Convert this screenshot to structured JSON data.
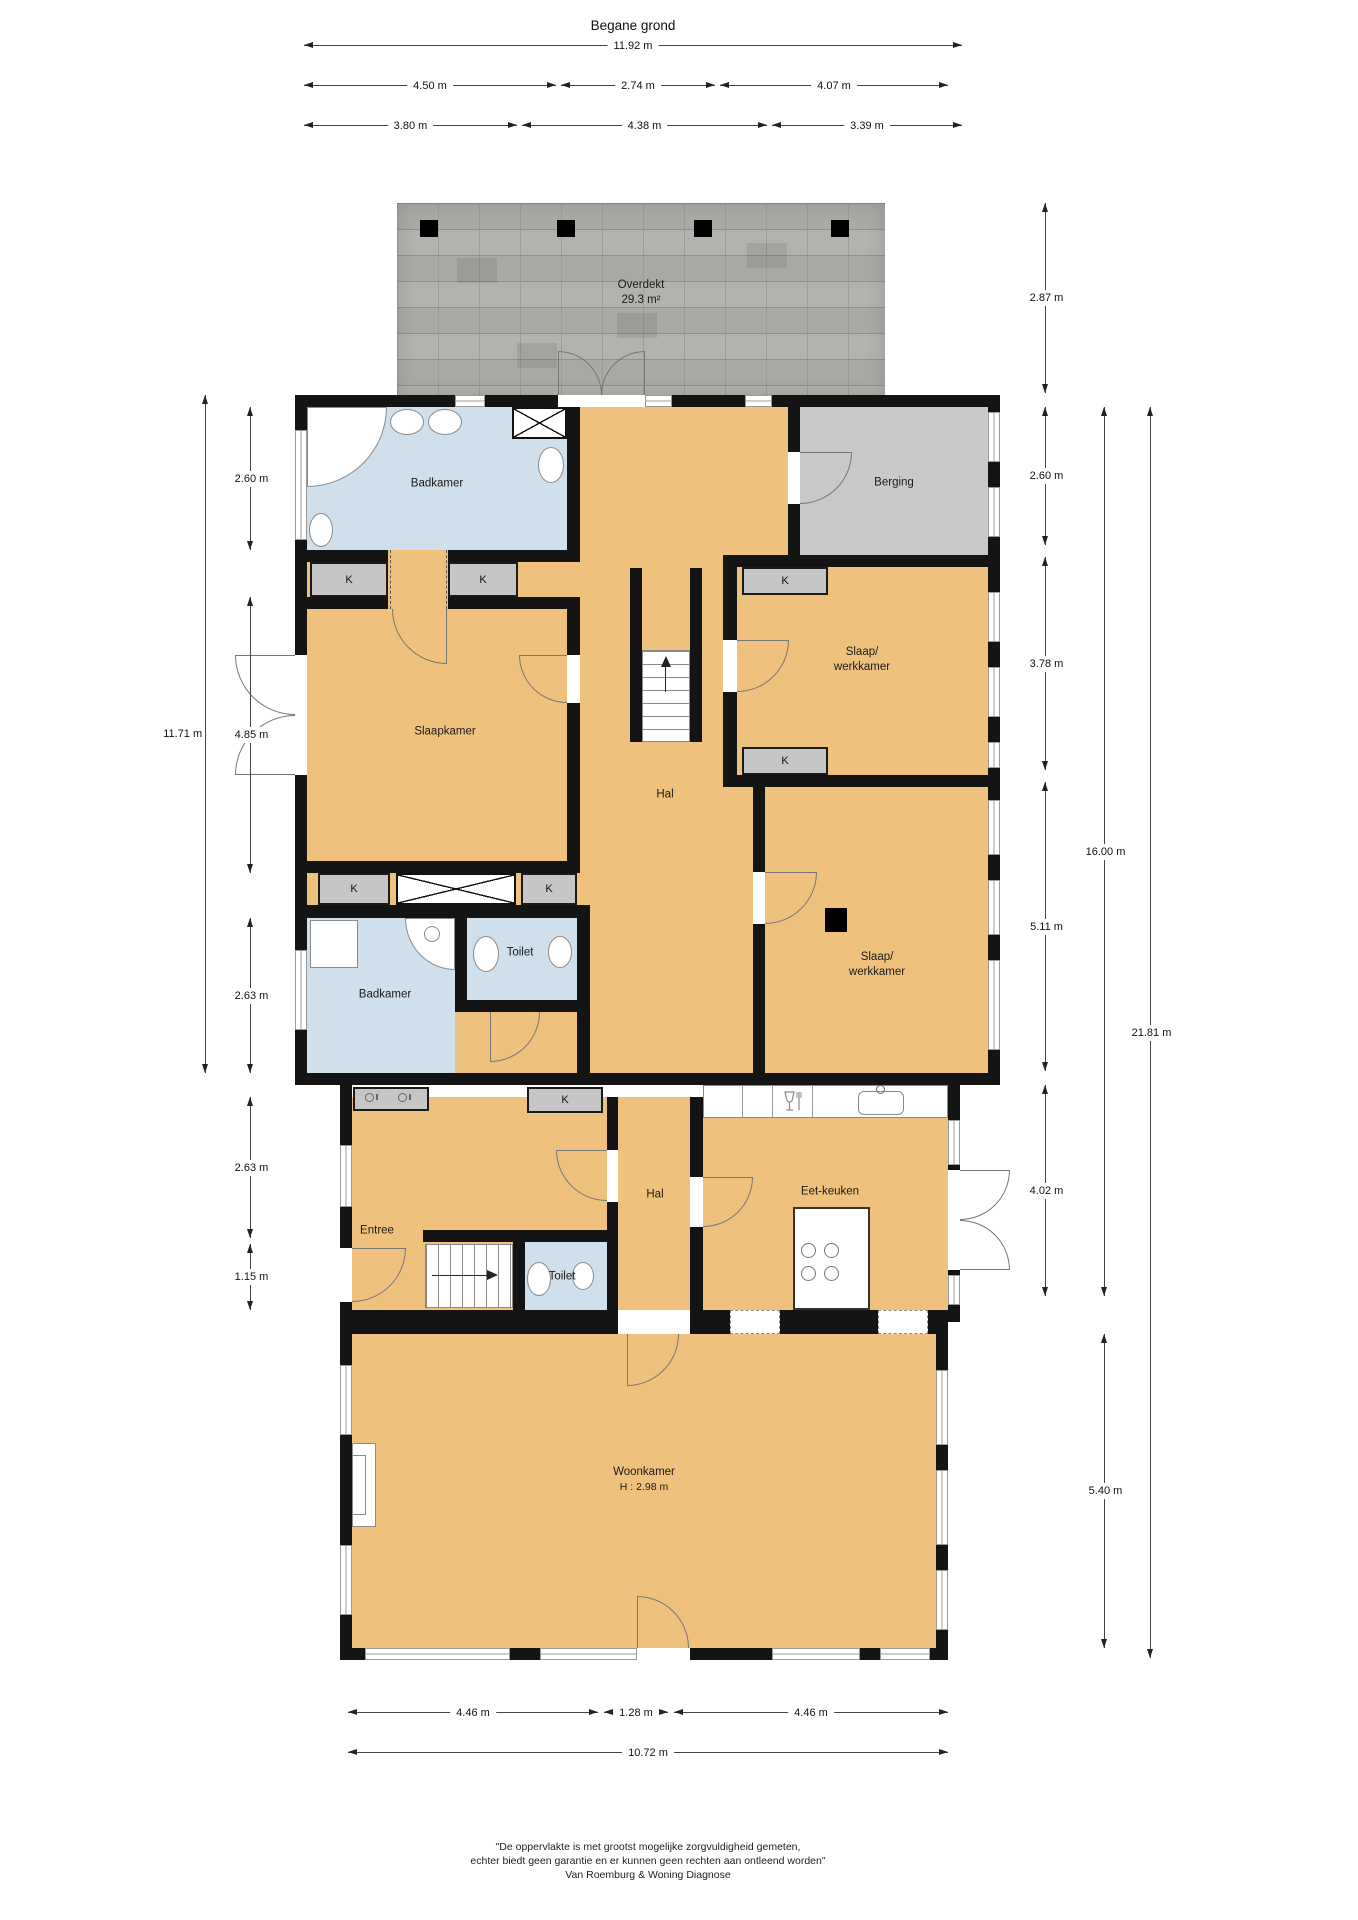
{
  "page_title": "Begane grond",
  "floor_plan": {
    "rooms": {
      "overdekt": {
        "name": "Overdekt",
        "area": "29.3 m²"
      },
      "badkamer_boven": "Badkamer",
      "berging": "Berging",
      "slaapkamer": "Slaapkamer",
      "slaap_werkkamer_1": {
        "line1": "Slaap/",
        "line2": "werkkamer"
      },
      "slaap_werkkamer_2": {
        "line1": "Slaap/",
        "line2": "werkkamer"
      },
      "hal_boven": "Hal",
      "toilet_boven": "Toilet",
      "badkamer_onder": "Badkamer",
      "entree": "Entree",
      "hal_onder": "Hal",
      "eet_keuken": "Eet-keuken",
      "toilet_onder": "Toilet",
      "woonkamer": {
        "name": "Woonkamer",
        "ceiling_height": "H : 2.98 m"
      },
      "kast_label": "K"
    },
    "dimensions": {
      "top": [
        "11.92 m",
        "4.50 m",
        "2.74 m",
        "4.07 m",
        "3.80 m",
        "4.38 m",
        "3.39 m"
      ],
      "left": [
        "2.60 m",
        "11.71 m",
        "4.85 m",
        "2.63 m",
        "2.63 m",
        "1.15 m"
      ],
      "right": [
        "2.87 m",
        "2.60 m",
        "3.78 m",
        "5.11 m",
        "4.02 m",
        "16.00 m",
        "5.40 m",
        "21.81 m"
      ],
      "bottom": [
        "4.46 m",
        "1.28 m",
        "4.46 m",
        "10.72 m"
      ]
    },
    "colors": {
      "floor": "#eec17d",
      "wet_room": "#cfdfec",
      "storage": "#c9c9c9",
      "closet": "#c6c6c6",
      "wall": "#141414",
      "roof": "#b2b2ae"
    }
  },
  "footer": {
    "line1": "\"De oppervlakte is met grootst mogelijke zorgvuldigheid gemeten,",
    "line2": "echter biedt geen garantie en er kunnen geen rechten aan ontleend worden\"",
    "line3": "Van Roemburg & Woning Diagnose"
  }
}
